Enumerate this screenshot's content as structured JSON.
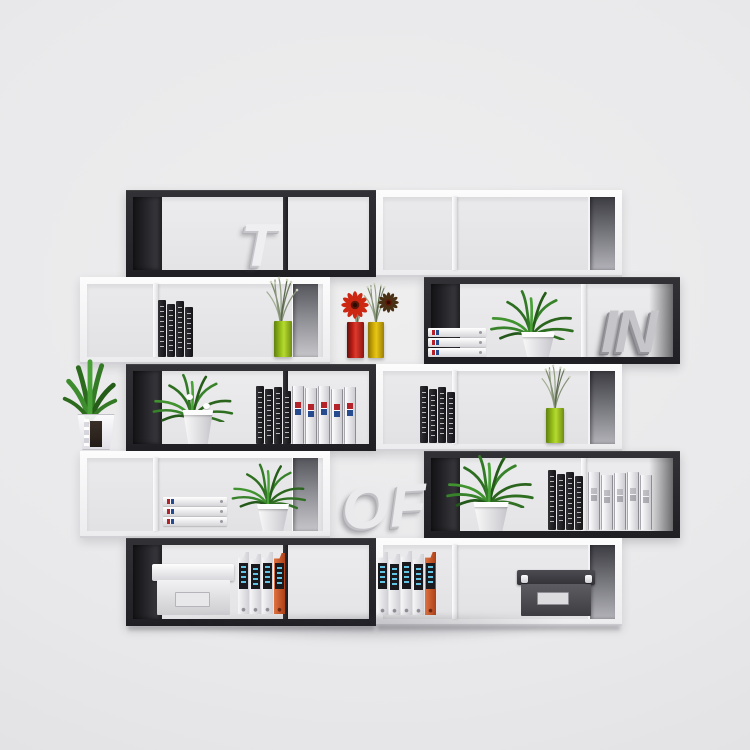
{
  "scene": {
    "type": "furniture product photo",
    "subject": "Modern 5-tier black and white S-shaped zigzag bookcase, two mirrored units, styled with plants, books, binders and storage boxes",
    "wall_color": "#eaeaec",
    "floor_color": "#e2e2e4"
  },
  "decor_letters": {
    "t": "T",
    "in": "IN",
    "of": "OF"
  },
  "palette": {
    "black_frame": "#26262a",
    "white_frame": "#f6f6f8",
    "vase_green": "#a3c926",
    "vase_red": "#c32014",
    "vase_yellow": "#ddb30a",
    "binder_orange": "#cc5a26",
    "binder_label_blue": "#5fc0e0",
    "plant_green": "#3a8229",
    "letter_silver": "#c4c4c8"
  },
  "bookshelf": {
    "tiers": 5,
    "units": 2,
    "left_unit_tier_colors": [
      "black",
      "white",
      "black",
      "white",
      "black"
    ],
    "right_unit_tier_colors": [
      "white",
      "black",
      "white",
      "black",
      "white"
    ]
  },
  "contents": {
    "tier_1": [
      "white 3D letter T in left black frame",
      "empty right white frame with dark end section"
    ],
    "tier_2": [
      "row of black books",
      "green vase with dried grass",
      "red gerbera in red glass vase",
      "yellow glass vase with dried stems and dark flower",
      "stack of three white binders",
      "green plant in white pot",
      "silver 3D letters IN"
    ],
    "tier_3": [
      "aloe plant in ribbed glass vase",
      "white-flowering plant in white pot",
      "row of black books",
      "five white document binders with red and blue labels",
      "row of black books",
      "green vase with dried grass"
    ],
    "tier_4": [
      "stack of three white binders",
      "green plant in white pot",
      "white 3D letters OF",
      "green plant in white pot",
      "row of black books",
      "five grey document binders"
    ],
    "tier_5": [
      "white storage box with lid",
      "four lever-arch files, rightmost orange",
      "five lever-arch files, rightmost orange",
      "dark grey storage box with metal corners"
    ]
  }
}
